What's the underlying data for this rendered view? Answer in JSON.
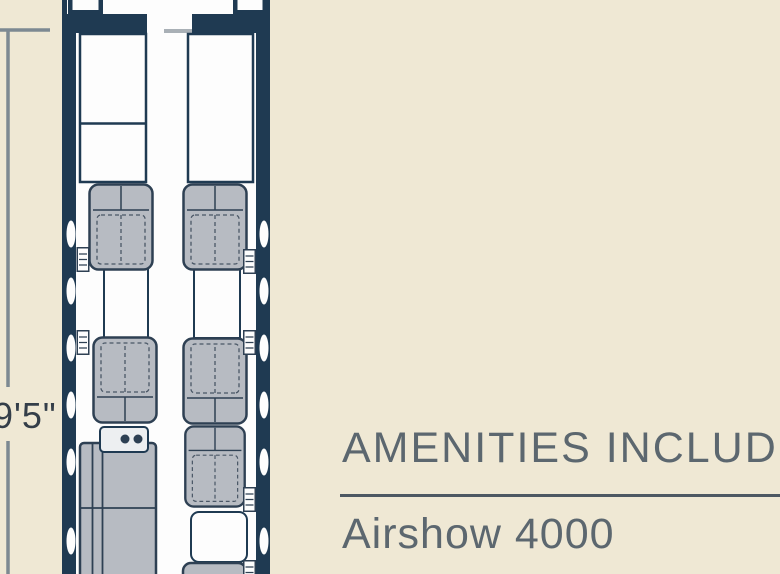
{
  "page": {
    "type": "aircraft cabin floor plan brochure panel",
    "background_color": "#EFE8D4"
  },
  "floorplan": {
    "dimension_label": "9'5\"",
    "windows_visible_left": 6,
    "windows_visible_right": 6,
    "club_seats_visible": 6,
    "divan_count": 1,
    "colors": {
      "fuselage": "#1F3A52",
      "interior_white": "#FDFDFD",
      "seat_fill": "#B7BBC2",
      "seat_outline": "#2E4053",
      "dimension_line": "#7D8992",
      "dimension_text": "#343E49"
    }
  },
  "amenities": {
    "heading": "AMENITIES INCLUDE",
    "item": "Airshow 4000",
    "text_color": "#5C676F",
    "divider_color": "#4D5862"
  }
}
